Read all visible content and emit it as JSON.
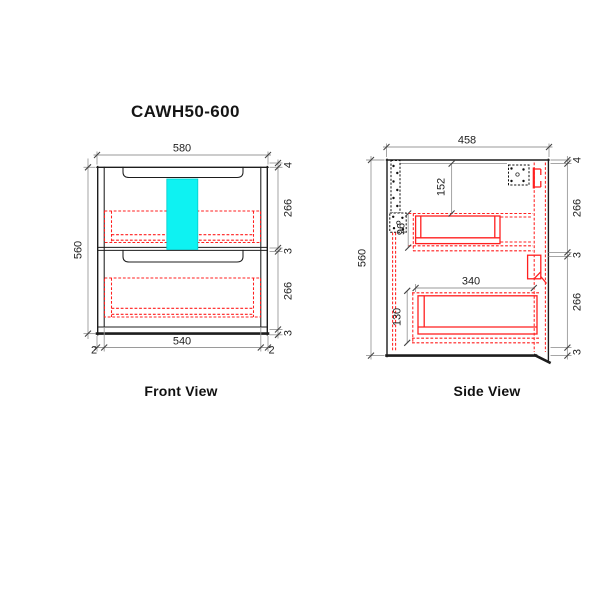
{
  "title": "CAWH50-600",
  "colors": {
    "outline": "#1d1d1d",
    "hidden_parts": "#ff1f1f",
    "highlight": "#0ef2f2",
    "dimension": "#9a9a9a",
    "text": "#1f1f1f"
  },
  "front_view": {
    "caption": "Front View",
    "dims": {
      "top_width": "580",
      "left_height": "560",
      "bottom_inner_width": "540",
      "bottom_gap_left": "2",
      "bottom_gap_right": "2",
      "right_chain": [
        "4",
        "266",
        "3",
        "266",
        "3"
      ]
    }
  },
  "side_view": {
    "caption": "Side View",
    "dims": {
      "top_depth": "458",
      "left_height": "560",
      "drawer1_top_offset": "152",
      "drawer1_side_height": "96",
      "drawer2_runner_length": "340",
      "drawer2_side_height": "130",
      "right_chain": [
        "4",
        "266",
        "3",
        "266",
        "3"
      ]
    }
  }
}
